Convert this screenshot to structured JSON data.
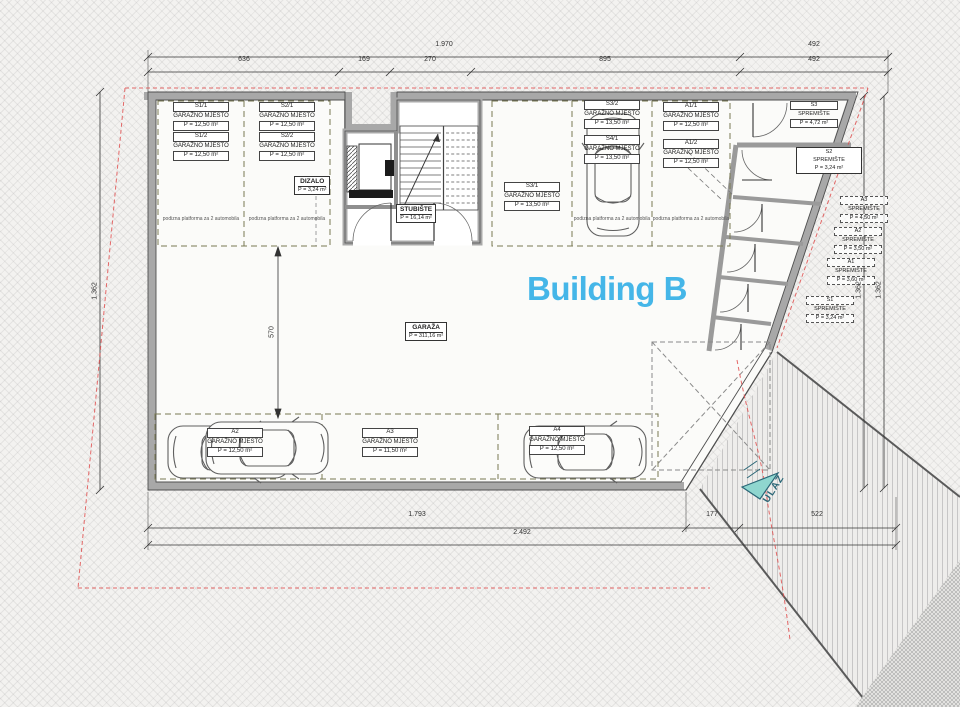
{
  "title": "Building B",
  "entrance": {
    "label": "ULAZ"
  },
  "rooms": {
    "garage": {
      "name": "GARAŽA",
      "area": "P = 311,16 m²"
    },
    "stairs": {
      "name": "STUBIŠTE",
      "area": "P = 16,14 m²"
    },
    "elevator": {
      "name": "DIZALO",
      "area": "P = 3,24 m²"
    }
  },
  "platform_note": "podizna platforma za 2 automobila",
  "parking_spots": [
    {
      "id": "S1/1",
      "type": "GARAŽNO MJESTO",
      "area": "P = 12,50 m²"
    },
    {
      "id": "S1/2",
      "type": "GARAŽNO MJESTO",
      "area": "P = 12,50 m²"
    },
    {
      "id": "S2/1",
      "type": "GARAŽNO MJESTO",
      "area": "P = 12,50 m²"
    },
    {
      "id": "S2/2",
      "type": "GARAŽNO MJESTO",
      "area": "P = 12,50 m²"
    },
    {
      "id": "S3/1",
      "type": "GARAŽNO MJESTO",
      "area": "P = 13,50 m²"
    },
    {
      "id": "S3/2",
      "type": "GARAŽNO MJESTO",
      "area": "P = 13,50 m²"
    },
    {
      "id": "S4/1",
      "type": "GARAŽNO MJESTO",
      "area": "P = 13,50 m²"
    },
    {
      "id": "A1/1",
      "type": "GARAŽNO MJESTO",
      "area": "P = 12,50 m²"
    },
    {
      "id": "A1/2",
      "type": "GARAŽNO MJESTO",
      "area": "P = 12,50 m²"
    },
    {
      "id": "A2",
      "type": "GARAŽNO MJESTO",
      "area": "P = 12,50 m²"
    },
    {
      "id": "A3",
      "type": "GARAŽNO MJESTO",
      "area": "P = 11,50 m²"
    },
    {
      "id": "A4",
      "type": "GARAŽNO MJESTO",
      "area": "P = 12,50 m²"
    }
  ],
  "storage_rooms": [
    {
      "id": "S3",
      "name": "SPREMIŠTE",
      "area": "P = 4,72 m²"
    },
    {
      "id": "S2",
      "name": "SPREMIŠTE",
      "area": "P = 3,24 m²"
    },
    {
      "id": "A3",
      "name": "SPREMIŠTE",
      "area": "P = 4,50 m²"
    },
    {
      "id": "A2",
      "name": "SPREMIŠTE",
      "area": "P = 3,50 m²"
    },
    {
      "id": "A1",
      "name": "SPREMIŠTE",
      "area": "P = 3,60 m²"
    },
    {
      "id": "S1",
      "name": "SPREMIŠTE",
      "area": "P = 3,24 m²"
    }
  ],
  "dimensions": {
    "top_total": "1.970",
    "top_right": "492",
    "top_segments": [
      "636",
      "169",
      "270",
      "895",
      "492"
    ],
    "bottom_segments": [
      "1.793",
      "177",
      "522"
    ],
    "bottom_total": "2.492",
    "left_vertical": "1.362",
    "right_vertical_1": "1.362",
    "right_vertical_2": "1.362",
    "inner_vertical": "570"
  },
  "colors": {
    "accent": "#45b6e8",
    "wall_gray": "#a8a8a8",
    "parking_dash": "#7a7a52",
    "boundary_red": "#e04f4f",
    "entrance_fill": "#8fd6cf",
    "entrance_stroke": "#2b6777"
  }
}
